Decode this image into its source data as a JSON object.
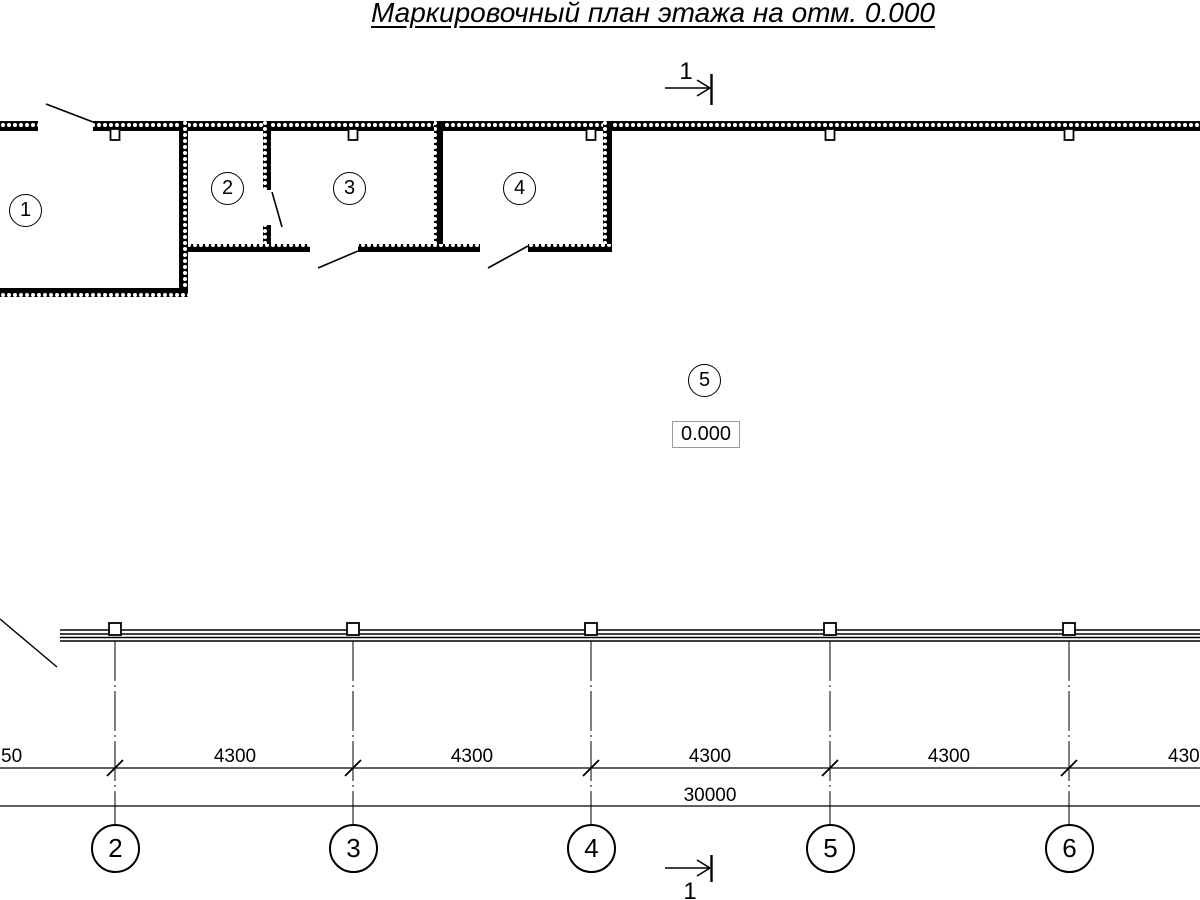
{
  "title": "Маркировочный план этажа на отм. 0.000",
  "plan": {
    "room_tags": [
      "1",
      "2",
      "3",
      "4",
      "5"
    ],
    "elevation_mark": "0.000"
  },
  "section_cut": {
    "top_label": "1",
    "bottom_label": "1"
  },
  "grid": {
    "axis_labels": [
      "2",
      "3",
      "4",
      "5",
      "6"
    ],
    "dim_segments": [
      "50",
      "4300",
      "4300",
      "4300",
      "4300",
      "430"
    ],
    "dim_total": "30000"
  },
  "colors": {
    "line": "#000000",
    "background": "#ffffff",
    "elevation_box_border": "#9a9a9a"
  }
}
